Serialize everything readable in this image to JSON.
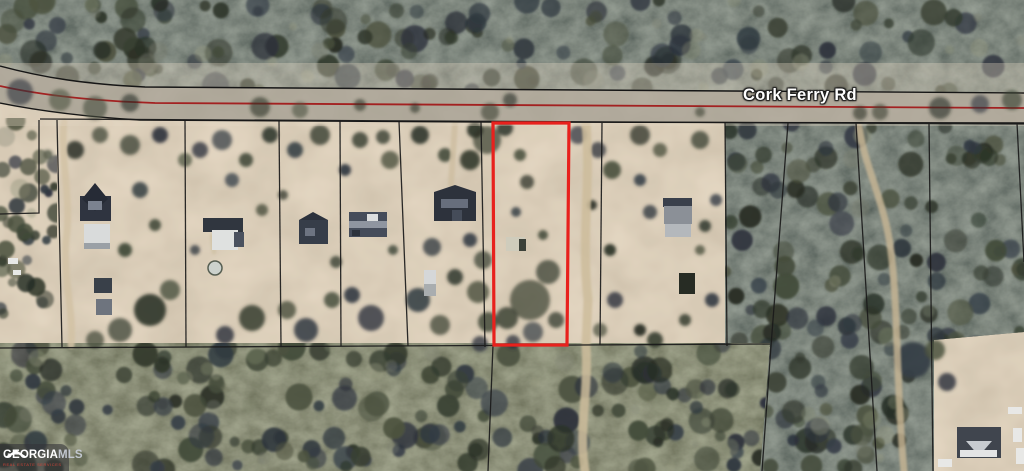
{
  "listing_map": {
    "road_label": "Cork Ferry Rd",
    "subject_parcel_outline_color": "#e8211d",
    "road_centerline_color": "#a32121",
    "parcel_line_color": "#1b1b1b",
    "watermark": {
      "brand": "GEORGIA",
      "brand_suffix": "MLS",
      "tagline": "REAL ESTATE SERVICES"
    }
  }
}
